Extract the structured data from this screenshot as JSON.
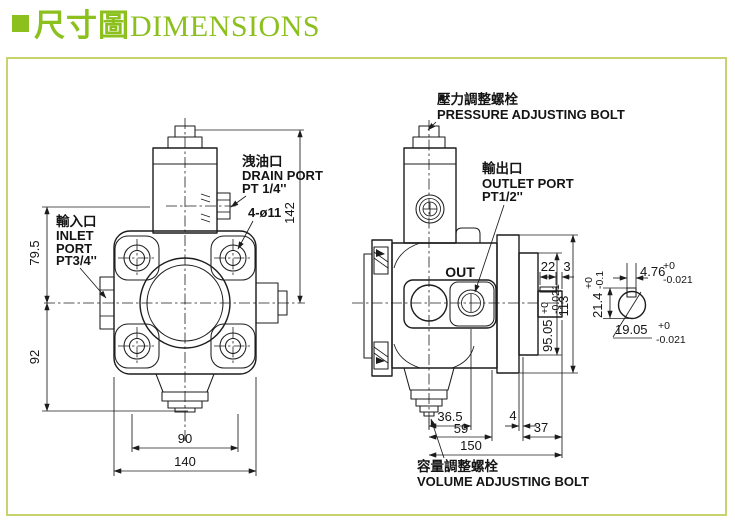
{
  "header": {
    "title_zh": "尺寸圖",
    "title_en": "DIMENSIONS"
  },
  "colors": {
    "accent_green": "#8cc01e",
    "frame_border": "#c9d36e",
    "line_color": "#1c1c1c"
  },
  "front_view": {
    "labels": {
      "drain_zh": "洩油口",
      "drain_en": "DRAIN PORT",
      "drain_size": "PT 1/4''",
      "inlet_zh": "輸入口",
      "inlet_en1": "INLET",
      "inlet_en2": "PORT",
      "inlet_size": "PT3/4''",
      "bolt_holes": "4-ø11"
    },
    "dims": {
      "overall_height": "142",
      "inlet_to_drain": "79.5",
      "inlet_to_bolt_tip": "92",
      "bolt_spacing": "90",
      "overall_width": "140"
    }
  },
  "side_view": {
    "labels": {
      "pressure_zh": "壓力調整螺栓",
      "pressure_en": "PRESSURE ADJUSTING BOLT",
      "outlet_zh": "輸出口",
      "outlet_en": "OUTLET PORT",
      "outlet_size": "PT1/2''",
      "out_mark": "OUT",
      "volume_zh": "容量調整螺栓",
      "volume_en": "VOLUME ADJUSTING BOLT"
    },
    "dims": {
      "key_length": "22",
      "key_to_end": "3",
      "spigot_dia": "95.05",
      "spigot_tol_up": "+0",
      "spigot_tol_low": "-0.021",
      "flange_height": "113",
      "tip_to_port": "36.5",
      "tip_to_face": "59",
      "overall_length": "150",
      "plate_step": "4",
      "shaft_length": "37"
    }
  },
  "shaft_detail": {
    "key_width": "4.76",
    "key_width_tol_up": "+0",
    "key_width_tol_low": "-0.021",
    "flat_height": "21.4",
    "flat_tol_up": "+0",
    "flat_tol_low": "-0.1",
    "shaft_dia": "19.05",
    "dia_tol_up": "+0",
    "dia_tol_low": "-0.021"
  }
}
